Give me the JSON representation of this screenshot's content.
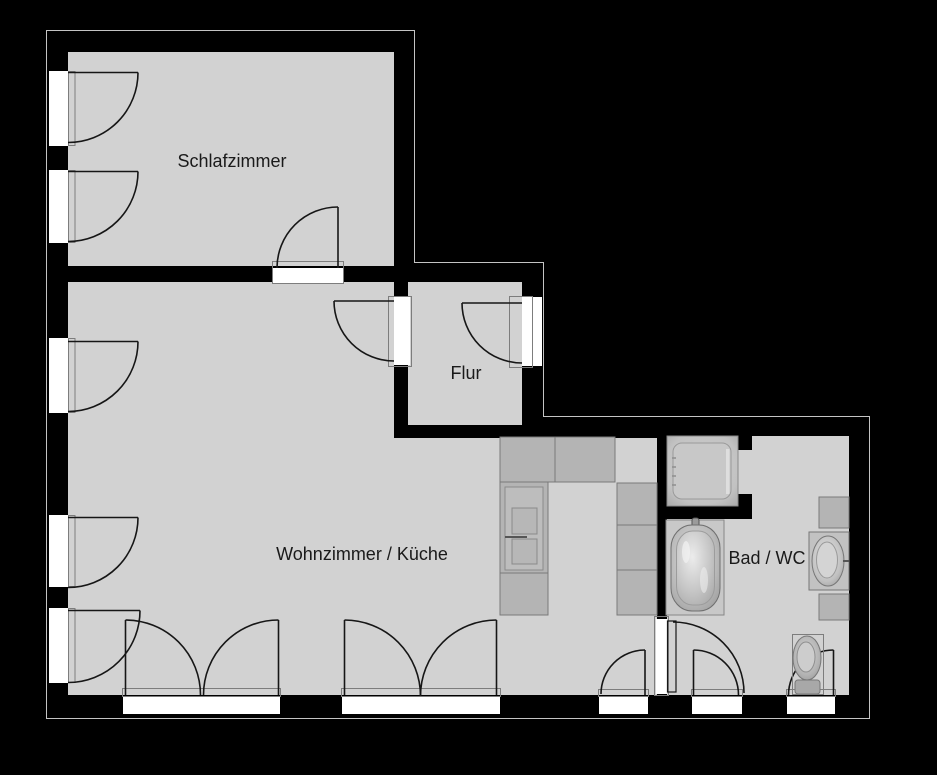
{
  "plan": {
    "type": "apartment-floor-plan",
    "rooms": [
      {
        "id": "schlafzimmer",
        "label": "Schlafzimmer"
      },
      {
        "id": "flur",
        "label": "Flur"
      },
      {
        "id": "wohnzimmer_kueche",
        "label": "Wohnzimmer / Küche"
      },
      {
        "id": "bad_wc",
        "label": "Bad / WC"
      }
    ],
    "fixtures": [
      {
        "id": "shower",
        "name": "shower-tray"
      },
      {
        "id": "bathtub",
        "name": "bathtub"
      },
      {
        "id": "washbasin",
        "name": "washbasin-with-counter"
      },
      {
        "id": "toilet",
        "name": "toilet"
      },
      {
        "id": "stove",
        "name": "kitchen-stove-unit"
      },
      {
        "id": "kitchen_counters",
        "name": "kitchen-counter-units"
      }
    ],
    "openings": {
      "windows_left_wall": 5,
      "french_doors_bottom": 2,
      "single_windows_bottom": 3,
      "interior_doors": 3,
      "entrance_door": 1
    }
  },
  "colors": {
    "bg": "#000000",
    "floor": "#d2d2d2",
    "wall": "#000000",
    "opening": "#ffffff",
    "counter": "#b4b4b4",
    "label": "#1a1a1a"
  }
}
